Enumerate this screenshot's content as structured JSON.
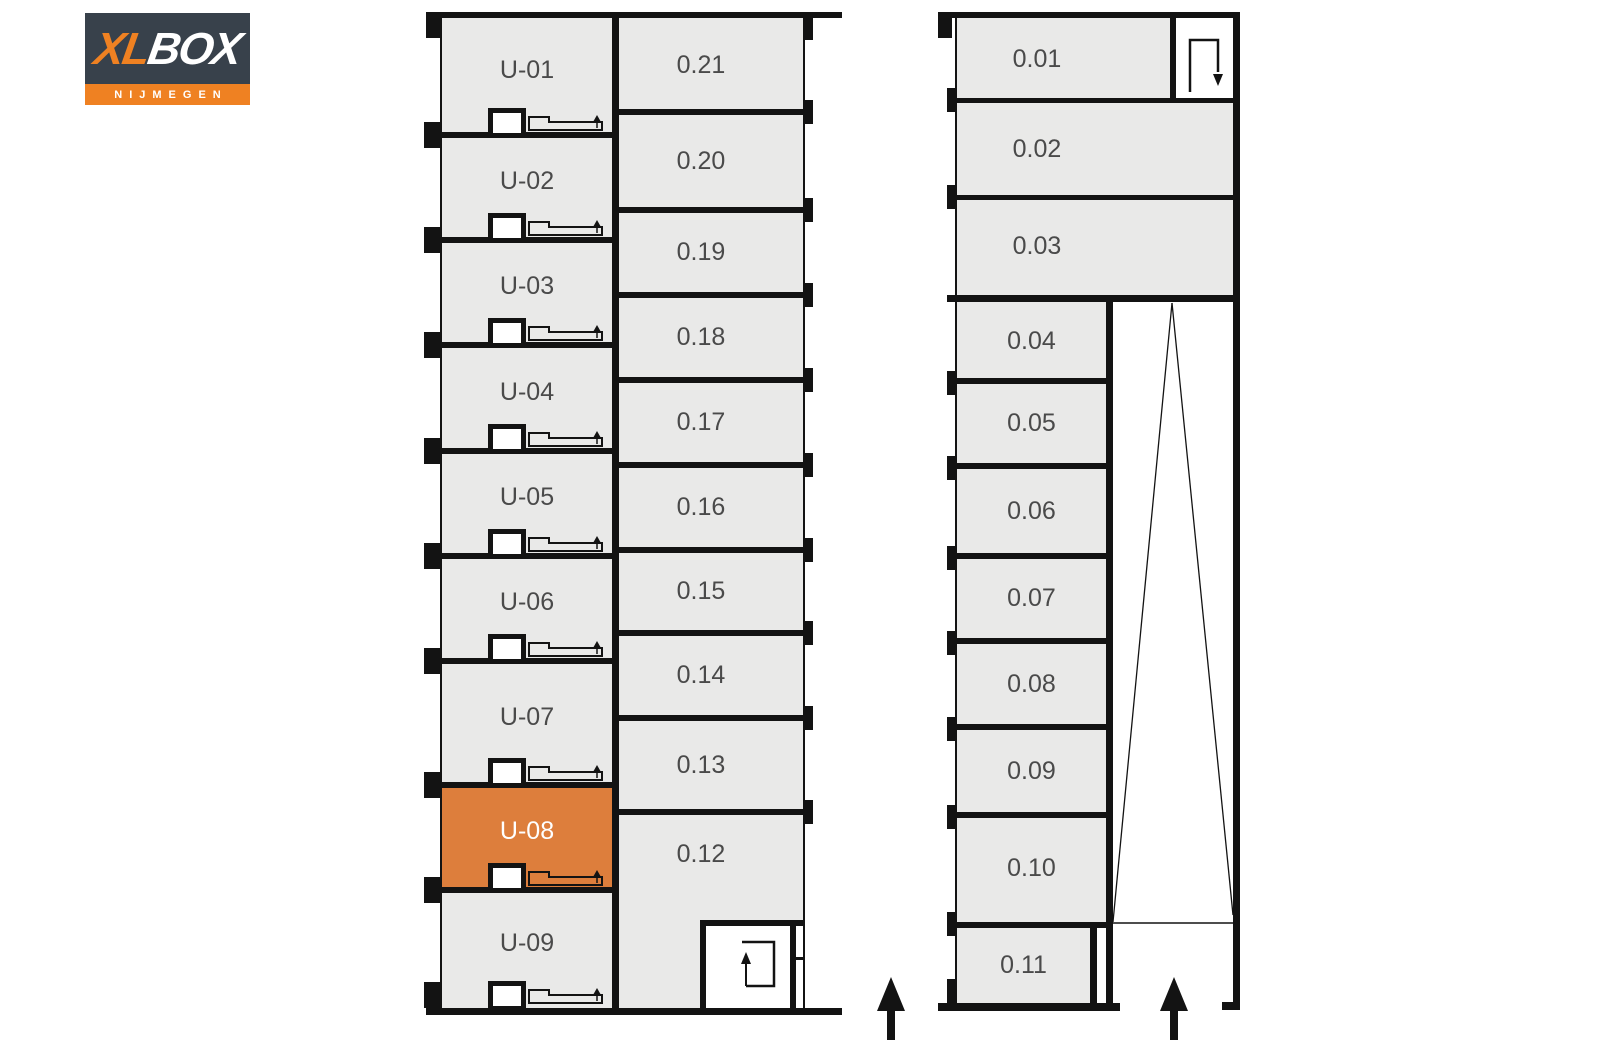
{
  "logo": {
    "xl": "XL",
    "box": "BOX",
    "city": "NIJMEGEN"
  },
  "plan": {
    "left_building": {
      "garage_units": [
        "U-01",
        "U-02",
        "U-03",
        "U-04",
        "U-05",
        "U-06",
        "U-07",
        "U-08",
        "U-09"
      ],
      "highlighted_unit": "U-08",
      "storage_rooms": [
        "0.21",
        "0.20",
        "0.19",
        "0.18",
        "0.17",
        "0.16",
        "0.15",
        "0.14",
        "0.13",
        "0.12"
      ]
    },
    "right_building": {
      "storage_rooms": [
        "0.01",
        "0.02",
        "0.03",
        "0.04",
        "0.05",
        "0.06",
        "0.07",
        "0.08",
        "0.09",
        "0.10",
        "0.11"
      ]
    }
  },
  "icons": {
    "garage_door": "garage-door-icon",
    "door_post": "door-post-square",
    "stairs_up": "stair-entry-up-icon",
    "stairs_down": "stair-entry-down-icon",
    "entrance_arrow": "entrance-arrow-icon",
    "ramp": "ramp-lines"
  },
  "colors": {
    "wall": "#131313",
    "room_fill": "#e9e9e8",
    "label_text": "#4a4a4a",
    "highlight_fill": "#dd7e3c",
    "highlight_text": "#ffffff",
    "logo_bg": "#38414b",
    "logo_orange": "#ef8122"
  }
}
